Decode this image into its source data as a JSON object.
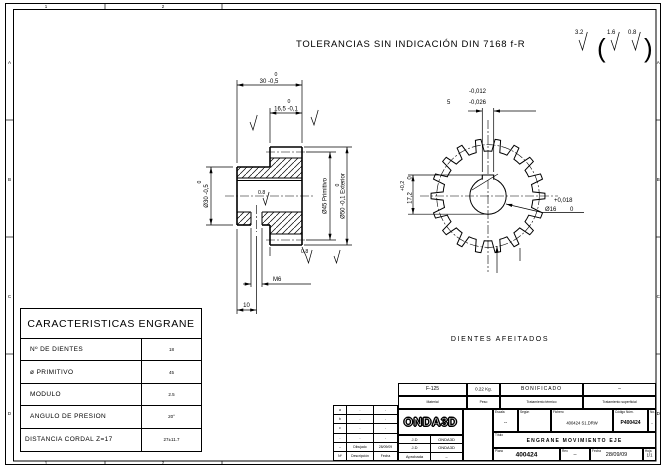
{
  "zones": {
    "numbers": [
      "1",
      "2"
    ],
    "letters": [
      "A",
      "B",
      "C",
      "D"
    ]
  },
  "header": {
    "tolerance_note": "TOLERANCIAS SIN INDICACIÓN DIN 7168 f-R",
    "roughness_general": "3.2",
    "roughness_fine": "1.6",
    "roughness_finest": "0.8"
  },
  "section_view": {
    "width_total_tol": "0",
    "width_total": "30 -0,5",
    "face_width_tol": "0",
    "face_width": "16,5 -0,1",
    "hub_dia_tol": "0",
    "hub_dia": "Ø30 -0,5",
    "pitch_dia": "Ø45 Primitivo",
    "outer_dia_tol": "0",
    "outer_dia": "Ø50 -0,1 Exterior",
    "thread": "M6",
    "thread_offset": "10",
    "ra_bore": "0.8",
    "ra_face": "0.8"
  },
  "front_view": {
    "teeth": 18,
    "keyway_tol_up": "-0,012",
    "keyway_width": "5",
    "keyway_tol_lo": "-0,026",
    "keyway_depth_tol": "+0,2",
    "keyway_depth": "17,2",
    "keyway_depth_tol_lo": "0",
    "bore_tol_up": "+0,018",
    "bore_dia": "Ø16",
    "bore_tol_lo": "0",
    "note": "DIENTES AFEITADOS"
  },
  "characteristics": {
    "title": "CARACTERISTICAS ENGRANE",
    "rows": [
      {
        "label": "Nº DE DIENTES",
        "value": "18"
      },
      {
        "label": "ø PRIMITIVO",
        "value": "45"
      },
      {
        "label": "MODULO",
        "value": "2.5"
      },
      {
        "label": "ANGULO DE PRESION",
        "value": "20°"
      },
      {
        "label": "DISTANCIA CORDAL Z=17",
        "value": "27±11.7"
      }
    ]
  },
  "title_block": {
    "materials": [
      {
        "label": "Material",
        "value": "F-125"
      },
      {
        "label": "Peso",
        "value": "0.22 Kg."
      },
      {
        "label": "Tratamiento térmico",
        "value": "BONIFICADO"
      },
      {
        "label": "Tratamiento superficial",
        "value": "–"
      }
    ],
    "revisions": [
      [
        "a",
        "-",
        "-"
      ],
      [
        "b",
        "-",
        "-"
      ],
      [
        "c",
        "-",
        "-"
      ],
      [
        "-",
        "-",
        "-"
      ],
      [
        "--",
        "Dibujado",
        "28/09/09"
      ],
      [
        "Nº",
        "Descripción",
        "Fecha"
      ]
    ],
    "signatures": [
      [
        "J.D",
        "ONDA3D"
      ],
      [
        "J.D",
        "ONDA3D"
      ],
      [
        "Aprobada",
        "–"
      ]
    ],
    "logo": "ONDA3D",
    "info": {
      "escala_label": "Escala",
      "escala": "--",
      "segun_label": "Según",
      "segun": "",
      "fichero_label": "Fichero",
      "fichero": "400424 S1.DRW",
      "codigo_label": "Código Núm.",
      "codigo": "P400424",
      "no_label": "No.",
      "no": "--",
      "titulo_label": "Título",
      "titulo": "ENGRANE MOVIMIENTO EJE",
      "plano_label": "Plano",
      "plano": "400424",
      "rev_label": "Rev.",
      "rev": "--",
      "fecha_label": "Fecha",
      "fecha": "28/09/09",
      "hoja_label": "Hoja",
      "hoja": "1/1"
    }
  }
}
